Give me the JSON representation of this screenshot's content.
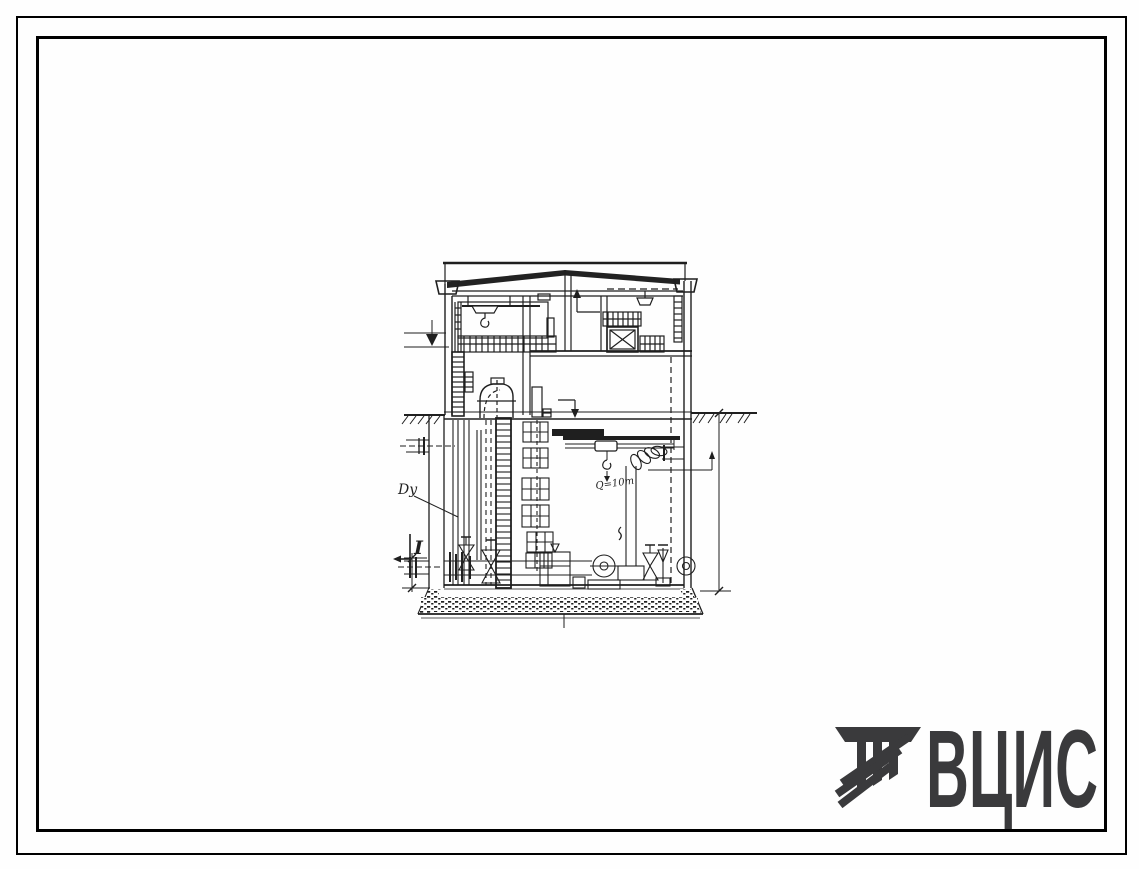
{
  "sheet": {
    "background": "#fefefe",
    "ink_color": "#1f1f1f"
  },
  "frame": {
    "outer_color": "#000000",
    "inner_color": "#000000"
  },
  "drawing": {
    "labels": {
      "pipe_diameter": "Dy",
      "section_mark": "I",
      "hoist_capacity": "Q=10т"
    }
  },
  "logo": {
    "text": "ВЦИС",
    "color": "#3a3a3c"
  }
}
